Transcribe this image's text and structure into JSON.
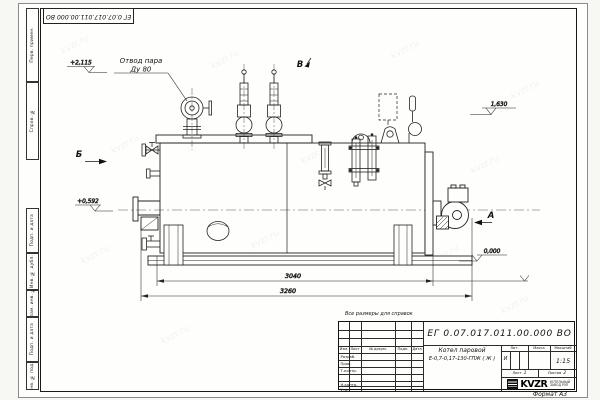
{
  "sheet": {
    "format_label": "Формат А3",
    "reference_note": "Все размеры для справок",
    "watermark_text": "kvzr.ru"
  },
  "drawing": {
    "callout_line1": "Отвод пара",
    "callout_line2": "Ду 80",
    "view_a": "А",
    "view_b": "Б",
    "view_v": "В",
    "elev_top": "+2,115",
    "elev_mid": "+0,592",
    "elev_right": "1,630",
    "elev_zero": "0,000",
    "dim_shell": "3040",
    "dim_overall": "3260"
  },
  "stamp_strip": {
    "cells": [
      "Перв. примен.",
      "Справ. №",
      "Подп. и дата",
      "Инв. № дубл.",
      "Взам. инв. №",
      "Подп. и дата",
      "Инв. № подл."
    ]
  },
  "title_block": {
    "designation": "ЕГ 0.07.017.011.00.000  ВО",
    "product_name_line1": "Котел паровой",
    "product_name_line2": "Е-0,7-0,17-130-ГПЖ ( Ж )",
    "col_headers": [
      "Изм.",
      "Лист",
      "№ докум.",
      "Подп.",
      "Дата"
    ],
    "row_labels": [
      "Разраб.",
      "Пров.",
      "Т.контр.",
      "Н.контр.",
      "Утв."
    ],
    "lit_header": "Лит.",
    "mass_header": "Масса",
    "scale_header": "Масштаб",
    "lit_value": "И",
    "scale_value": "1:15",
    "sheet_label": "Лист",
    "sheet_value": "1",
    "sheets_label": "Листов",
    "sheets_total": "2",
    "company_logo": "KVZR",
    "company_caption_line1": "КОТЕЛЬНЫЙ",
    "company_caption_line2": "ЗАВОД РЭП"
  }
}
